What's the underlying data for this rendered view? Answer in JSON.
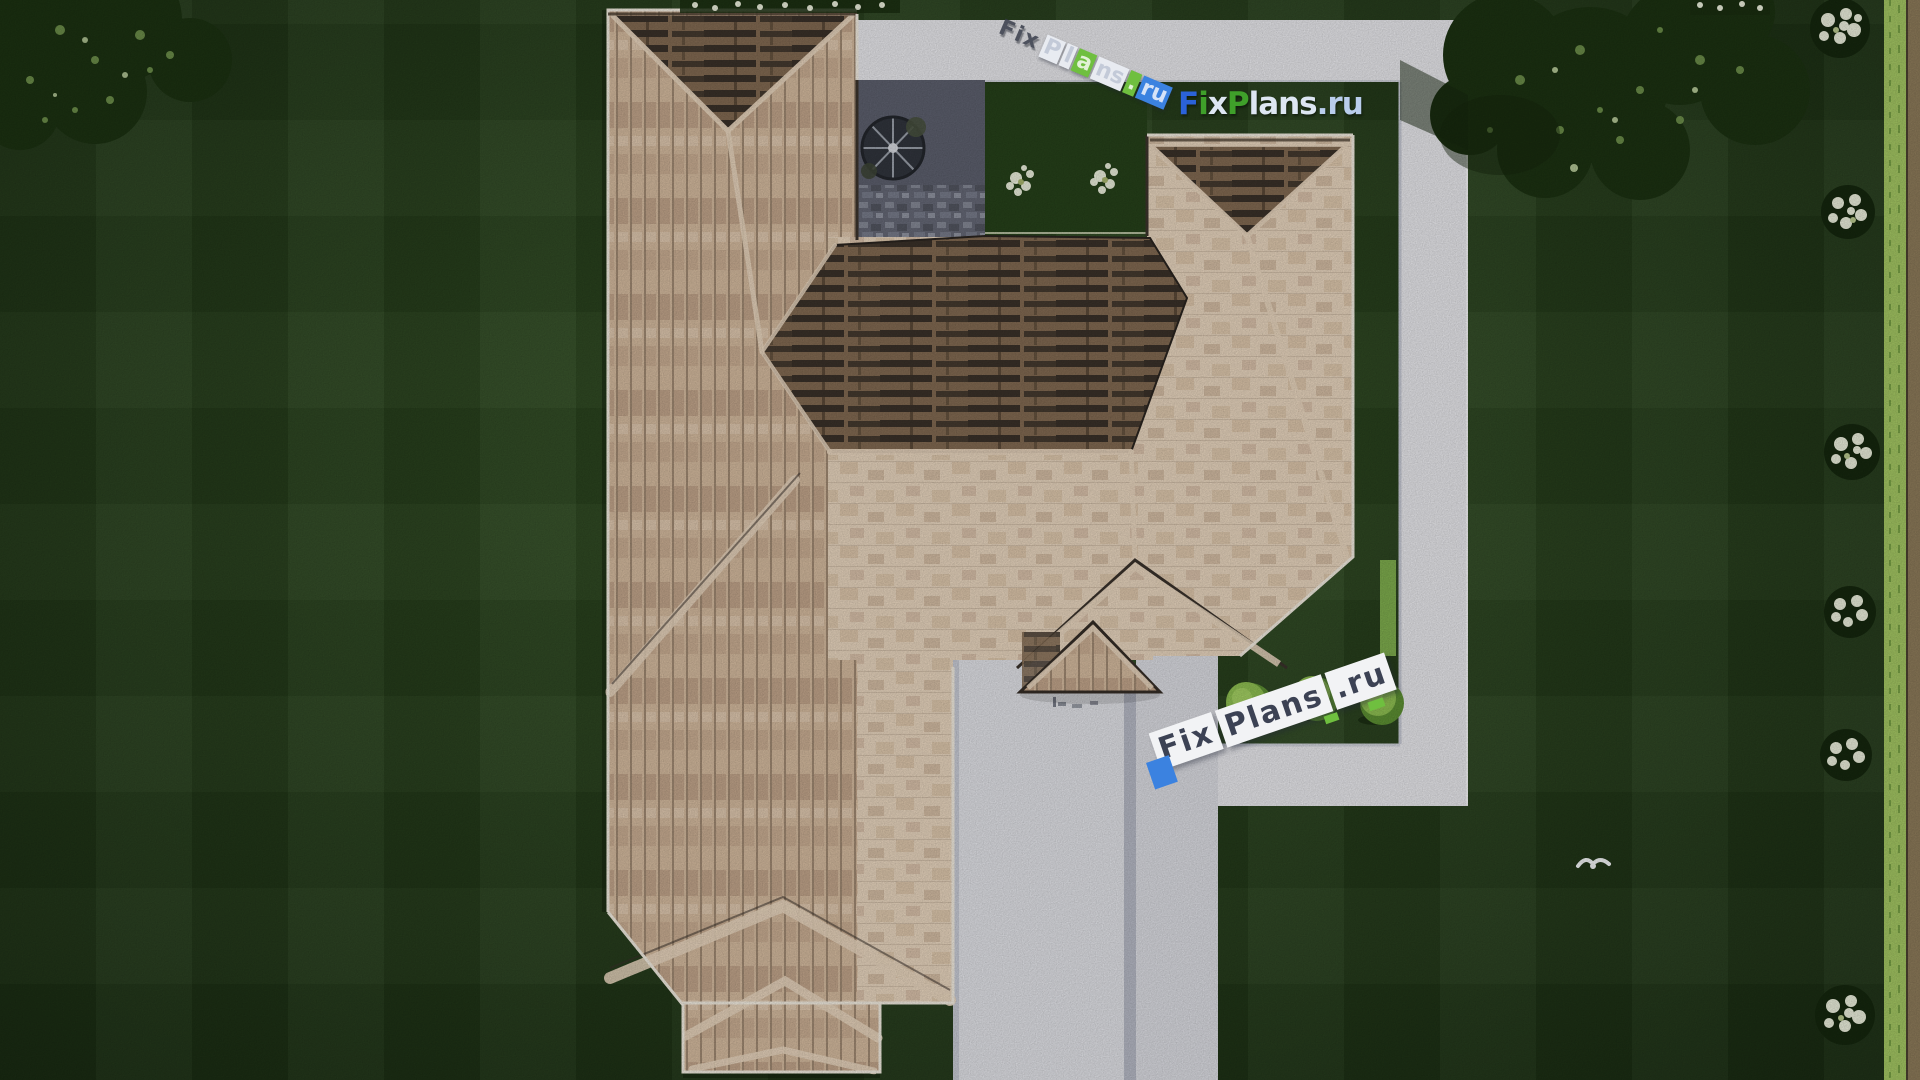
{
  "branding": {
    "logo": {
      "text": "FixPlans.ru",
      "segments": [
        {
          "t": "F"
        },
        {
          "t": "i"
        },
        {
          "t": "x"
        },
        {
          "t": "P"
        },
        {
          "t": "lans"
        },
        {
          "t": ".ru"
        }
      ]
    },
    "watermark_top": {
      "text": "FixPlans.ru",
      "segments": [
        {
          "t": "Fix"
        },
        {
          "t": "P"
        },
        {
          "t": "l"
        },
        {
          "t": "a"
        },
        {
          "t": "ns"
        },
        {
          "t": "."
        },
        {
          "t": "ru"
        }
      ]
    },
    "watermark_mid": {
      "text": "FixPlans.ru",
      "segments": [
        {
          "t": "Fix"
        },
        {
          "t": "Plans"
        },
        {
          "t": ".ru"
        }
      ]
    }
  },
  "colors": {
    "lawn": "#2e4b22",
    "lawn_dark": "#203918",
    "foliage": "#1c3212",
    "foliage_light": "#7fa457",
    "flower": "#ebefdc",
    "hedge": "#a4c763",
    "bush": "#8fc052",
    "walkway": "#e9e9ed",
    "driveway": "#e2e3e8",
    "driveway2": "#dcdde3",
    "concrete_gap": "#b7bac6",
    "courtyard": "#5d606e",
    "garden": "#26411a",
    "roof_light": "#e9d6bf",
    "roof_mid": "#d5bb9f",
    "roof_stripe": "#b3947a",
    "roof_dark": "#362e27",
    "roof_darkmid": "#826a52",
    "fascia": "#46392c",
    "eave": "#f2ece0",
    "logo_blue": "#2b62d9",
    "logo_green": "#3fa02a",
    "logo_light": "#dde6f2",
    "logo_lightblue": "#b9cdec",
    "wm_dark": "#3c4254",
    "wm_plate": "#f2f3f5",
    "wm_blue": "#3b82e0",
    "wm_green": "#6fbf3f",
    "wm_shadow": "#343947"
  }
}
